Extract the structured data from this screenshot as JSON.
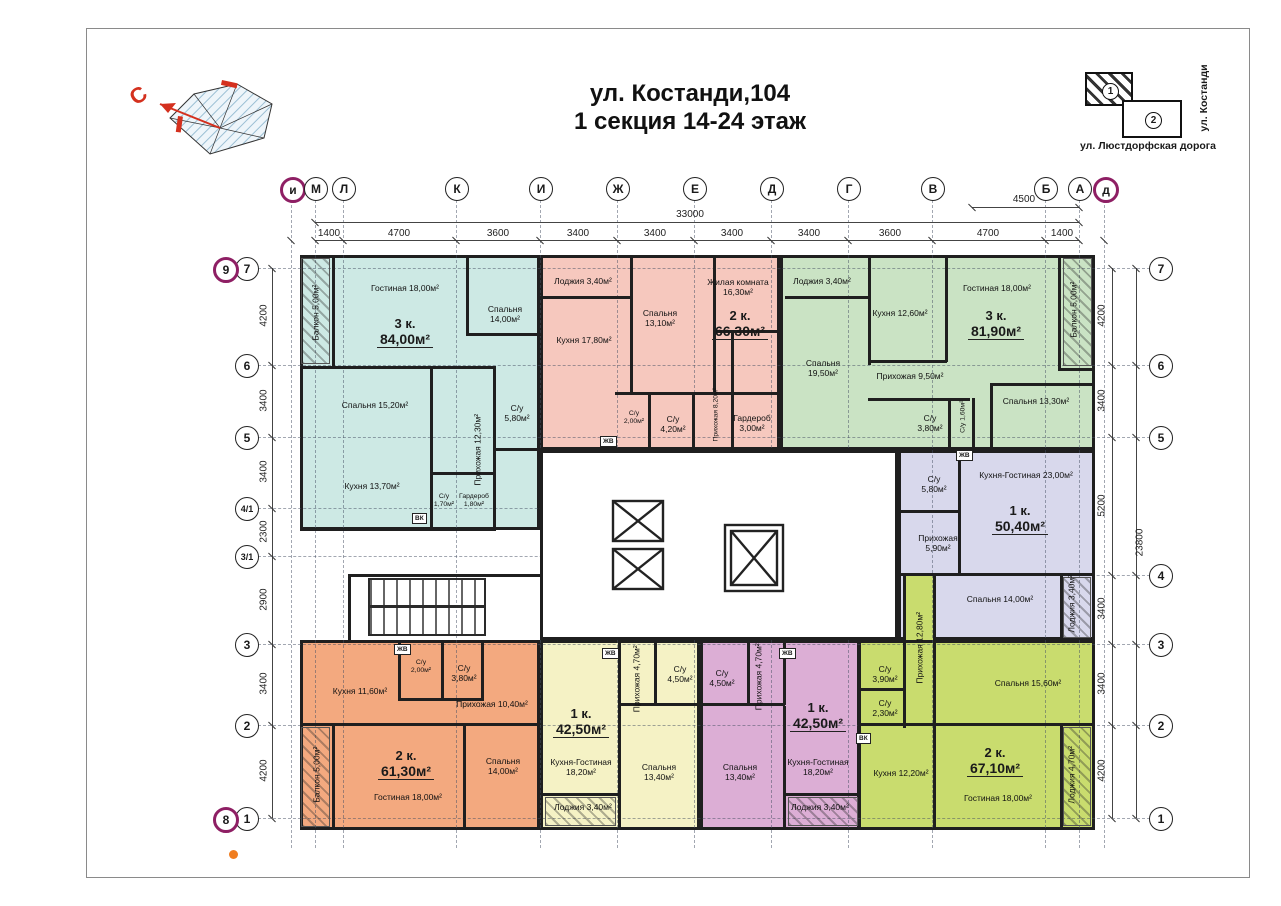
{
  "title": {
    "line1": "ул. Костанди,104",
    "line2": "1 секция 14-24 этаж"
  },
  "compass": {
    "north": "С"
  },
  "site_map": {
    "building1": "1",
    "building2": "2",
    "street_bottom": "ул. Люстдорфская дорога",
    "street_right": "ул. Костанди"
  },
  "grid": {
    "top_axes": [
      {
        "t": "и",
        "x": 291,
        "a": 1
      },
      {
        "t": "М",
        "x": 315
      },
      {
        "t": "Л",
        "x": 343
      },
      {
        "t": "К",
        "x": 456
      },
      {
        "t": "И",
        "x": 540
      },
      {
        "t": "Ж",
        "x": 617
      },
      {
        "t": "Е",
        "x": 694
      },
      {
        "t": "Д",
        "x": 771
      },
      {
        "t": "Г",
        "x": 848
      },
      {
        "t": "В",
        "x": 932
      },
      {
        "t": "Б",
        "x": 1045
      },
      {
        "t": "А",
        "x": 1079
      },
      {
        "t": "д",
        "x": 1104,
        "a": 1
      }
    ],
    "left_axes": [
      {
        "t": "7",
        "y": 268
      },
      {
        "t": "6",
        "y": 365
      },
      {
        "t": "5",
        "y": 437
      },
      {
        "t": "4/1",
        "y": 508
      },
      {
        "t": "3/1",
        "y": 556
      },
      {
        "t": "3",
        "y": 644
      },
      {
        "t": "2",
        "y": 725
      },
      {
        "t": "1",
        "y": 818
      }
    ],
    "left_accent": [
      {
        "t": "9",
        "y": 268
      },
      {
        "t": "8",
        "y": 818
      }
    ],
    "right_axes": [
      {
        "t": "7",
        "y": 268
      },
      {
        "t": "6",
        "y": 365
      },
      {
        "t": "5",
        "y": 437
      },
      {
        "t": "4",
        "y": 575
      },
      {
        "t": "3",
        "y": 644
      },
      {
        "t": "2",
        "y": 725
      },
      {
        "t": "1",
        "y": 818
      }
    ],
    "dims_top": [
      {
        "t": "1400",
        "x": 329
      },
      {
        "t": "4700",
        "x": 399
      },
      {
        "t": "3600",
        "x": 498
      },
      {
        "t": "3400",
        "x": 578
      },
      {
        "t": "3400",
        "x": 655
      },
      {
        "t": "3400",
        "x": 732
      },
      {
        "t": "3400",
        "x": 809
      },
      {
        "t": "3600",
        "x": 890
      },
      {
        "t": "4700",
        "x": 988
      },
      {
        "t": "1400",
        "x": 1062
      }
    ],
    "dim_total_top": {
      "t": "33000",
      "x": 690
    },
    "dim_4500": {
      "t": "4500",
      "x": 1024
    },
    "dims_left": [
      {
        "t": "4200",
        "y": 316
      },
      {
        "t": "3400",
        "y": 401
      },
      {
        "t": "3400",
        "y": 472
      },
      {
        "t": "2300",
        "y": 532
      },
      {
        "t": "2900",
        "y": 600
      },
      {
        "t": "3400",
        "y": 684
      },
      {
        "t": "4200",
        "y": 771
      }
    ],
    "dims_right": [
      {
        "t": "4200",
        "y": 316
      },
      {
        "t": "3400",
        "y": 401
      },
      {
        "t": "5200",
        "y": 506
      },
      {
        "t": "3400",
        "y": 609
      },
      {
        "t": "3400",
        "y": 684
      },
      {
        "t": "4200",
        "y": 771
      }
    ],
    "dim_total_right": {
      "t": "23800",
      "y": 543
    }
  },
  "apartments": [
    {
      "id": "apt-3k-84",
      "color": "#cde9e4",
      "type": "3 к.",
      "area": "84,00м²",
      "tx": 405,
      "ty": 326,
      "rooms": [
        {
          "t": "Балкон 5,00м²",
          "x": 316,
          "y": 315,
          "v": 1
        },
        {
          "t": "Гостиная 18,00м²",
          "x": 405,
          "y": 291
        },
        {
          "t": "Спальня 14,00м²",
          "x": 505,
          "y": 312,
          "w": 58
        },
        {
          "t": "Спальня 15,20м²",
          "x": 375,
          "y": 408
        },
        {
          "t": "Прихожая 12,30м²",
          "x": 478,
          "y": 452,
          "v": 1
        },
        {
          "t": "С/у 5,80м²",
          "x": 517,
          "y": 411,
          "w": 40
        },
        {
          "t": "Кухня 13,70м²",
          "x": 372,
          "y": 489
        },
        {
          "t": "С/у 1,70м²",
          "x": 444,
          "y": 500,
          "s": 1,
          "w": 30
        },
        {
          "t": "Гардероб 1,80м²",
          "x": 474,
          "y": 500,
          "s": 1,
          "w": 38
        }
      ]
    },
    {
      "id": "apt-2k-66",
      "color": "#f6c8be",
      "type": "2 к.",
      "area": "66,30м²",
      "tx": 740,
      "ty": 318,
      "rooms": [
        {
          "t": "Лоджия 3,40м²",
          "x": 583,
          "y": 284
        },
        {
          "t": "Кухня 17,80м²",
          "x": 584,
          "y": 343,
          "w": 58
        },
        {
          "t": "Спальня 13,10м²",
          "x": 660,
          "y": 316,
          "w": 58
        },
        {
          "t": "Жилая комната 16,30м²",
          "x": 738,
          "y": 285,
          "w": 88
        },
        {
          "t": "С/у 2,00м²",
          "x": 634,
          "y": 417,
          "s": 1,
          "w": 30
        },
        {
          "t": "С/у 4,20м²",
          "x": 673,
          "y": 422,
          "w": 40
        },
        {
          "t": "Прихожая 8,20м²",
          "x": 716,
          "y": 418,
          "v": 1,
          "s": 1
        },
        {
          "t": "Гардероб 3,00м²",
          "x": 752,
          "y": 421,
          "w": 56
        }
      ]
    },
    {
      "id": "apt-3k-81",
      "color": "#cae3c4",
      "type": "3 к.",
      "area": "81,90м²",
      "tx": 996,
      "ty": 318,
      "rooms": [
        {
          "t": "Лоджия 3,40м²",
          "x": 822,
          "y": 284
        },
        {
          "t": "Спальня 19,50м²",
          "x": 823,
          "y": 366,
          "w": 58
        },
        {
          "t": "Кухня 12,60м²",
          "x": 900,
          "y": 316,
          "w": 58
        },
        {
          "t": "Гостиная 18,00м²",
          "x": 997,
          "y": 291
        },
        {
          "t": "Балкон 5,00м²",
          "x": 1074,
          "y": 312,
          "v": 1
        },
        {
          "t": "Прихожая 9,50м²",
          "x": 910,
          "y": 379,
          "w": 100
        },
        {
          "t": "С/у 3,80м²",
          "x": 930,
          "y": 421,
          "w": 36
        },
        {
          "t": "С/у 1,60м²",
          "x": 963,
          "y": 420,
          "v": 1,
          "s": 1
        },
        {
          "t": "Спальня 13,30м²",
          "x": 1036,
          "y": 404,
          "w": 76
        }
      ]
    },
    {
      "id": "apt-1k-50",
      "color": "#d8d8ec",
      "type": "1 к.",
      "area": "50,40м²",
      "tx": 1020,
      "ty": 513,
      "rooms": [
        {
          "t": "С/у 5,80м²",
          "x": 934,
          "y": 482,
          "w": 40
        },
        {
          "t": "Кухня-Гостиная 23,00м²",
          "x": 1026,
          "y": 478,
          "w": 130
        },
        {
          "t": "Прихожая 5,90м²",
          "x": 938,
          "y": 541,
          "w": 60
        },
        {
          "t": "Спальня 14,00м²",
          "x": 1000,
          "y": 602,
          "w": 90
        },
        {
          "t": "Лоджия 3,40м²",
          "x": 1072,
          "y": 606,
          "v": 1
        }
      ]
    },
    {
      "id": "apt-2k-61",
      "color": "#f3a97f",
      "type": "2 к.",
      "area": "61,30м²",
      "tx": 406,
      "ty": 758,
      "rooms": [
        {
          "t": "Кухня 11,60м²",
          "x": 360,
          "y": 694,
          "w": 80
        },
        {
          "t": "С/у 2,00м²",
          "x": 421,
          "y": 666,
          "s": 1,
          "w": 30
        },
        {
          "t": "С/у 3,80м²",
          "x": 464,
          "y": 671,
          "w": 36
        },
        {
          "t": "Прихожая 10,40м²",
          "x": 492,
          "y": 707,
          "w": 84
        },
        {
          "t": "Гостиная 18,00м²",
          "x": 408,
          "y": 800,
          "w": 90
        },
        {
          "t": "Спальня 14,00м²",
          "x": 503,
          "y": 764,
          "w": 62
        },
        {
          "t": "Балкон 5,00м²",
          "x": 317,
          "y": 777,
          "v": 1
        }
      ]
    },
    {
      "id": "apt-1k-42a",
      "color": "#f5f2c5",
      "type": "1 к.",
      "area": "42,50м²",
      "tx": 581,
      "ty": 716,
      "rooms": [
        {
          "t": "Прихожая 4,70м²",
          "x": 637,
          "y": 681,
          "v": 1
        },
        {
          "t": "С/у 4,50м²",
          "x": 680,
          "y": 672,
          "w": 40
        },
        {
          "t": "Кухня-Гостиная 18,20м²",
          "x": 581,
          "y": 765,
          "w": 86
        },
        {
          "t": "Спальня 13,40м²",
          "x": 659,
          "y": 770,
          "w": 62
        },
        {
          "t": "Лоджия 3,40м²",
          "x": 583,
          "y": 810
        }
      ]
    },
    {
      "id": "apt-1k-42b",
      "color": "#dcaed5",
      "type": "1 к.",
      "area": "42,50м²",
      "tx": 818,
      "ty": 710,
      "rooms": [
        {
          "t": "С/у 4,50м²",
          "x": 722,
          "y": 676,
          "w": 40
        },
        {
          "t": "Прихожая 4,70м²",
          "x": 759,
          "y": 679,
          "v": 1
        },
        {
          "t": "Спальня 13,40м²",
          "x": 740,
          "y": 770,
          "w": 62
        },
        {
          "t": "Кухня-Гостиная 18,20м²",
          "x": 818,
          "y": 765,
          "w": 86
        },
        {
          "t": "Лоджия 3,40м²",
          "x": 820,
          "y": 810
        }
      ]
    },
    {
      "id": "apt-2k-67",
      "color": "#c9dc6e",
      "type": "2 к.",
      "area": "67,10м²",
      "tx": 995,
      "ty": 755,
      "rooms": [
        {
          "t": "Прихожая 12,80м²",
          "x": 920,
          "y": 650,
          "v": 1
        },
        {
          "t": "С/у 3,90м²",
          "x": 885,
          "y": 672,
          "w": 36
        },
        {
          "t": "С/у 2,30м²",
          "x": 885,
          "y": 706,
          "w": 36
        },
        {
          "t": "Спальня 15,60м²",
          "x": 1028,
          "y": 686,
          "w": 90
        },
        {
          "t": "Кухня 12,20м²",
          "x": 901,
          "y": 776,
          "w": 64
        },
        {
          "t": "Гостиная 18,00м²",
          "x": 998,
          "y": 801,
          "w": 90
        },
        {
          "t": "Лоджия 4,70м²",
          "x": 1072,
          "y": 777,
          "v": 1
        }
      ]
    }
  ],
  "shaft_labels": [
    {
      "t": "ВК",
      "x": 412,
      "y": 513
    },
    {
      "t": "ЖВ",
      "x": 600,
      "y": 436
    },
    {
      "t": "ЖВ",
      "x": 956,
      "y": 450
    },
    {
      "t": "ЖВ",
      "x": 394,
      "y": 644
    },
    {
      "t": "ЖВ",
      "x": 602,
      "y": 648
    },
    {
      "t": "ЖВ",
      "x": 779,
      "y": 648
    },
    {
      "t": "ВК",
      "x": 856,
      "y": 733
    }
  ]
}
